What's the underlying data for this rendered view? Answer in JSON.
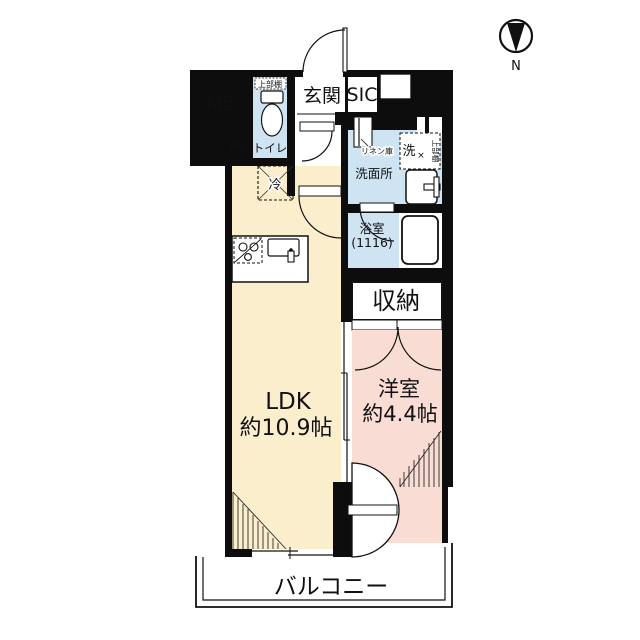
{
  "plan": {
    "compass": {
      "label": "N"
    },
    "rooms": {
      "mb": {
        "label": "MB"
      },
      "ps": {
        "label": "PS"
      },
      "toilet": {
        "label": "トイレ",
        "shelf_label": "上部棚"
      },
      "entrance": {
        "label": "玄関"
      },
      "sic": {
        "label": "SIC"
      },
      "washroom": {
        "label": "洗面所",
        "linen_label": "リネン庫",
        "washer_label": "洗",
        "washer_shelf_label": "上部棚",
        "washer_mark": "×"
      },
      "bathroom": {
        "label": "浴室",
        "size_label": "(1116)"
      },
      "storage": {
        "label": "収納"
      },
      "ldk": {
        "label": "LDK",
        "size_label": "約10.9帖"
      },
      "western_room": {
        "label": "洋室",
        "size_label": "約4.4帖"
      },
      "balcony": {
        "label": "バルコニー"
      },
      "refrigerator": {
        "label": "冷"
      }
    },
    "colors": {
      "wall": "#0d0d0d",
      "ldk_fill": "#faeecd",
      "western_room_fill": "#f9ddd5",
      "wet_area_fill": "#cfe4f2",
      "background": "#ffffff"
    }
  }
}
